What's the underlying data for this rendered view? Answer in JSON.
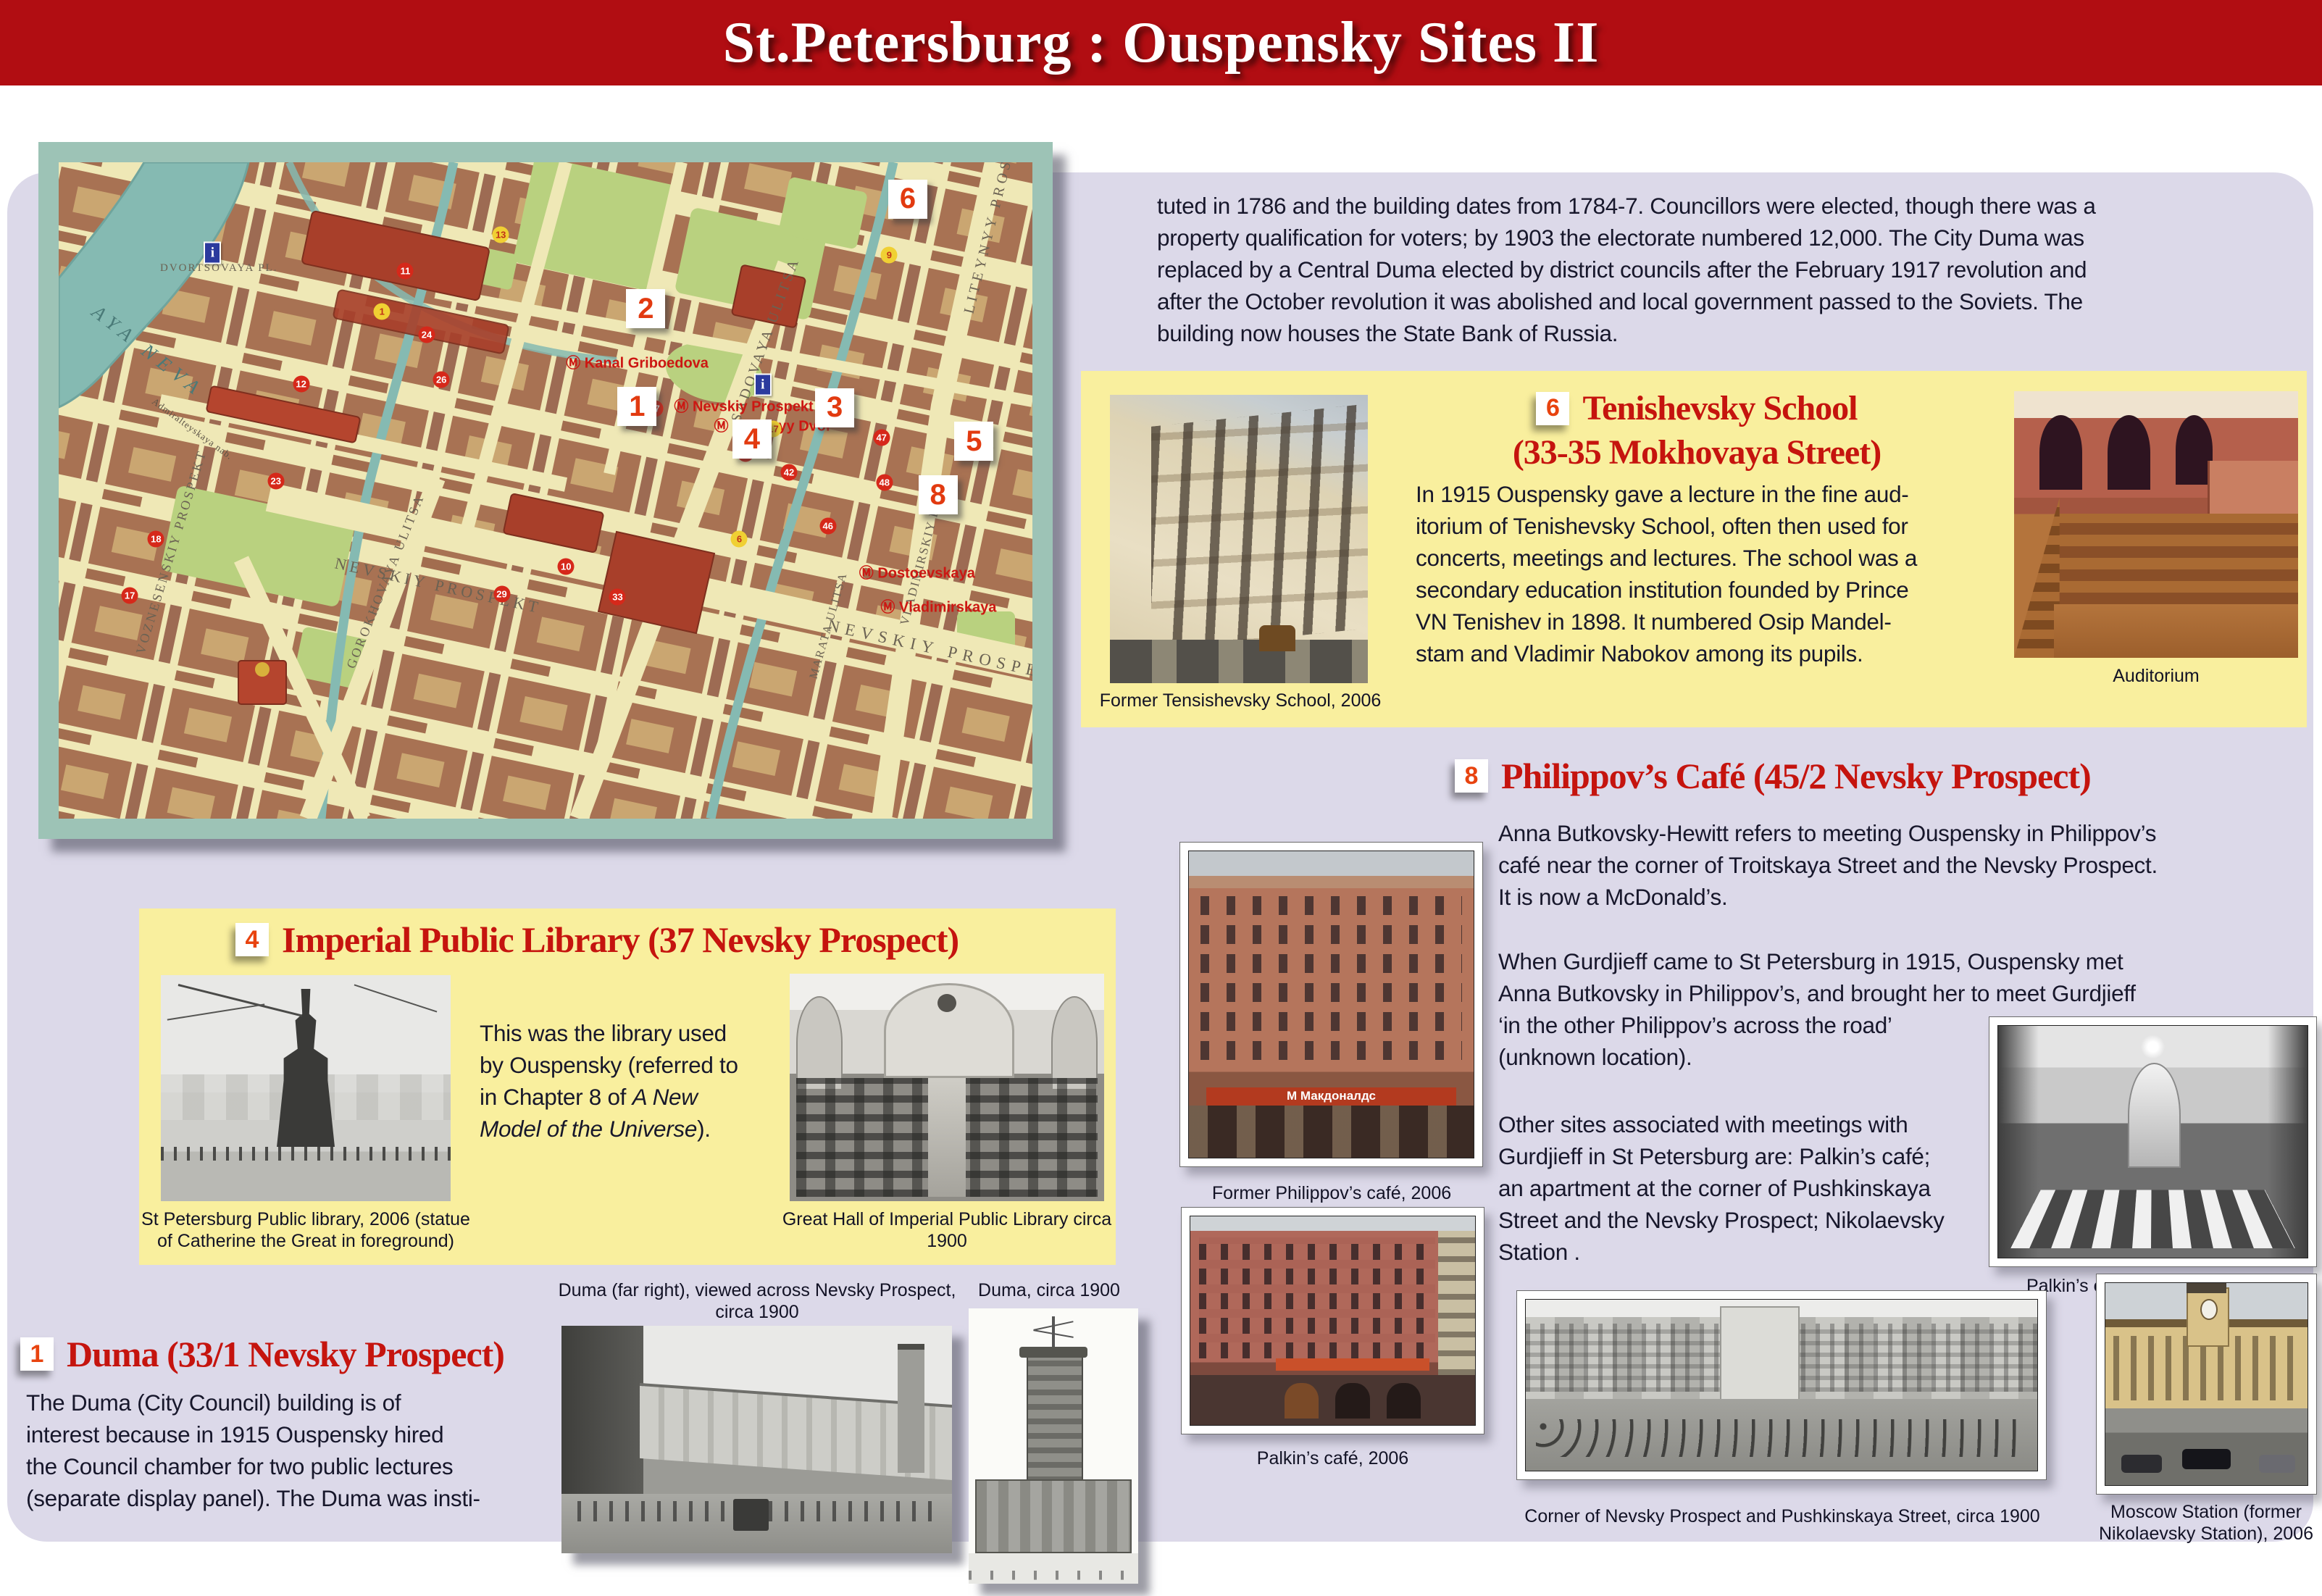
{
  "colors": {
    "header_red": "#b10d12",
    "heading_red": "#c5140e",
    "badge_number": "#e8430f",
    "panel_lavender": "#dcd9e9",
    "box_yellow": "#f9ef9e",
    "map_frame_teal": "#9dc3b6",
    "map_paper": "#efe8b6",
    "water_teal": "#85bab2"
  },
  "header": {
    "title": "St.Petersburg : Ouspensky Sites II"
  },
  "intro": "tuted in 1786 and the building dates from 1784-7.  Councillors were elected, though there was a\nproperty qualification for voters; by 1903 the electorate numbered 12,000.  The City Duma was\nreplaced by a Central Duma elected by district councils after the February 1917 revolution and\nafter the October revolution it was abolished and local government passed to the Soviets.  The\nbuilding now houses the State Bank of Russia.",
  "map": {
    "markers": [
      "6",
      "2",
      "1",
      "3",
      "4",
      "5",
      "8"
    ],
    "streets": {
      "nevskiy": "NEVSKIY PROSPEKT",
      "sadovaya": "SADOVAYA ULITSA",
      "liteyny": "LITEYNYY PROSPEKT",
      "gorokhovaya": "GOROKHOVAYA ULITSA",
      "voznesensky": "VOZNESENSKIY PROSPEKT",
      "vladimirsky": "VLADIMIRSKIY PR.",
      "marata": "MARATA ULITSA",
      "neva": "AYA NEVA",
      "nab": "Admiralteyskaya nab.",
      "dvortsovaya": "DVORTSOVAYA PL."
    },
    "metro": [
      "Ⓜ Kanal Griboedova",
      "Ⓜ Nevskiy Prospekt",
      "Ⓜ Gostinyy Dvor",
      "Ⓜ Dostoevskaya",
      "Ⓜ Vladimirskaya"
    ],
    "dots_red": [
      "11",
      "12",
      "24",
      "26",
      "23",
      "18",
      "17",
      "29",
      "10",
      "33",
      "37",
      "19",
      "42",
      "46",
      "47",
      "48"
    ],
    "dots_yellow": [
      "1",
      "13",
      "9",
      "17",
      "6"
    ],
    "info_letter": "i"
  },
  "sections": {
    "tenishevsky": {
      "badge": "6",
      "title1": "Tenishevsky School",
      "title2": "(33-35 Mokhovaya Street)",
      "body": "In 1915 Ouspensky gave a lecture in the fine aud-\nitorium of Tenishevsky School, often then used for\nconcerts, meetings and lectures.  The school was a\nsecondary education institution founded by Prince\nVN Tenishev in 1898. It numbered Osip Mandel-\nstam and Vladimir Nabokov among its pupils.",
      "caption_photo": "Former Tensishevsky School, 2006",
      "caption_auditorium": "Auditorium"
    },
    "philippov": {
      "badge": "8",
      "title": "Philippov’s Café (45/2 Nevsky Prospect)",
      "p1": "Anna Butkovsky-Hewitt refers to meeting Ouspensky in Philippov’s\ncafé near the corner of Troitskaya Street and the Nevsky Prospect.\nIt is now a McDonald’s.",
      "p2": "When Gurdjieff came to St Petersburg in 1915, Ouspensky met\nAnna Butkovsky in Philippov’s, and brought her to meet Gurdjieff\n‘in the other Philippov’s across the road’\n(unknown location).",
      "p3": "Other sites associated with meetings with\nGurdjieff in St Petersburg are: Palkin’s café;\nan apartment at the corner of Pushkinskaya\nStreet and the Nevsky Prospect; Nikolaevsky\nStation .",
      "sign": "М Макдоналдс",
      "caption_photo": "Former Philippov’s café, 2006",
      "caption_palkin_interior": "Palkin’s café interior, circa 1900",
      "caption_palkin": "Palkin’s café, 2006"
    },
    "library": {
      "badge": "4",
      "title": "Imperial Public Library (37 Nevsky Prospect)",
      "body_pre": "This was the library used\nby Ouspensky (referred to\nin Chapter 8 of ",
      "body_italic": "A New\nModel of the Universe",
      "body_post": ").",
      "caption_statue": "St Petersburg Public library, 2006 (statue\nof Catherine the Great in foreground)",
      "caption_hall": "Great Hall of Imperial Public Library circa\n1900"
    },
    "duma": {
      "badge": "1",
      "title": "Duma (33/1 Nevsky Prospect)",
      "body": "The Duma (City Council) building is of\ninterest because in 1915 Ouspensky hired\nthe Council chamber for two public lectures\n(separate display panel).  The Duma was insti-",
      "caption_wide": "Duma (far right), viewed across Nevsky Prospect,\ncirca 1900",
      "caption_tower": "Duma, circa 1900"
    },
    "bottom": {
      "caption_corner": "Corner of Nevsky Prospect and Pushkinskaya Street, circa 1900",
      "caption_station": "Moscow Station (former\nNikolaevsky Station), 2006"
    }
  }
}
